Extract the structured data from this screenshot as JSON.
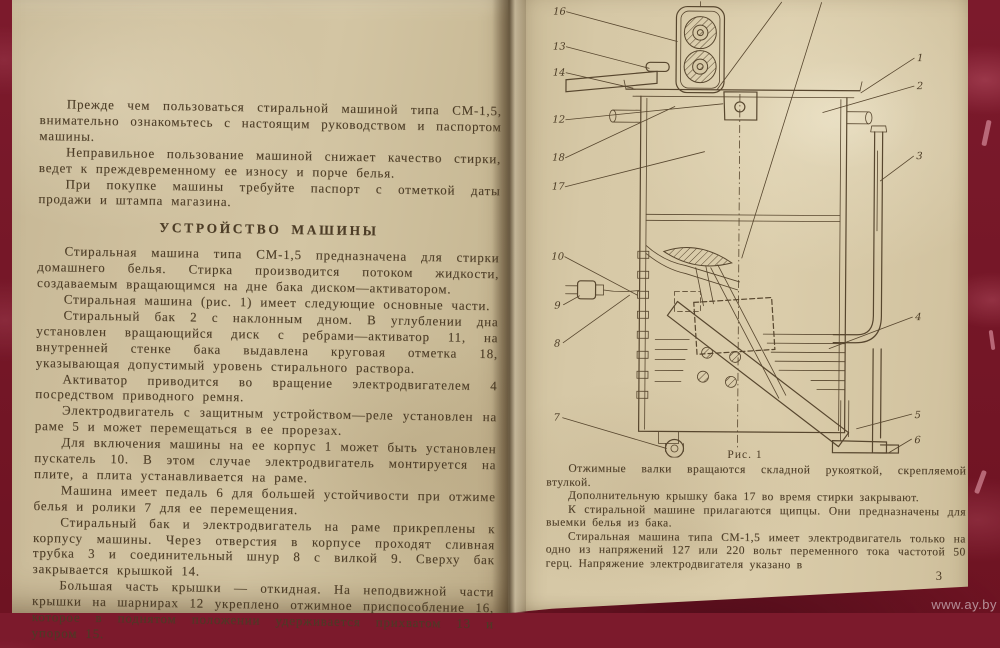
{
  "book": {
    "left_page": {
      "intro_paragraphs": [
        "Прежде чем пользоваться стиральной машиной типа СМ-1,5, внимательно ознакомьтесь с настоящим руководством и паспортом машины.",
        "Неправильное пользование машиной снижает качество стирки, ведет к преждевременному ее износу и порче белья.",
        "При покупке машины требуйте паспорт с отметкой даты продажи и штампа магазина."
      ],
      "section_heading": "УСТРОЙСТВО МАШИНЫ",
      "body_paragraphs": [
        "Стиральная машина типа СМ-1,5 предназначена для стирки домашнего белья. Стирка производится потоком жидкости, создаваемым вращающимся на дне бака диском—активатором.",
        "Стиральная машина (рис. 1) имеет следующие основные части.",
        "Стиральный бак 2 с наклонным дном. В углублении дна установлен вращающийся диск с ребрами—активатор 11, на внутренней стенке бака выдавлена круговая отметка 18, указывающая допустимый уровень стирального раствора.",
        "Активатор приводится во вращение электродвигателем 4 посредством приводного ремня.",
        "Электродвигатель с защитным устройством—реле установлен на раме 5 и может перемещаться в ее прорезах.",
        "Для включения машины на ее корпус 1 может быть установлен пускатель 10. В этом случае электродвигатель монтируется на плите, а плита устанавливается на раме.",
        "Машина имеет педаль 6 для большей устойчивости при отжиме белья и ролики 7 для ее перемещения.",
        "Стиральный бак и электродвигатель на раме прикреплены к корпусу машины. Через отверстия в корпусе проходят сливная трубка 3 и соединительный шнур 8 с вилкой 9. Сверху бак закрывается крышкой 14.",
        "Большая часть крышки — откидная. На неподвижной части крышки на шарнирах 12 укреплено отжимное приспособление 16, которое в поднятом положении удерживается прихватом 13 и упором 15."
      ]
    },
    "right_page": {
      "figure": {
        "caption": "Рис. 1",
        "callouts_left": [
          "16",
          "13",
          "14",
          "12",
          "18",
          "17",
          "10",
          "9",
          "8",
          "7"
        ],
        "callouts_right": [
          "1",
          "2",
          "3",
          "4",
          "5",
          "6"
        ]
      },
      "paragraphs": [
        "Отжимные валки вращаются складной рукояткой, скрепляемой втулкой.",
        "Дополнительную крышку бака 17 во время стирки закрывают.",
        "К стиральной машине прилагаются щипцы. Они предназначены для выемки белья из бака.",
        "Стиральная машина типа СМ-1,5 имеет электродвигатель только на одно из напряжений 127 или 220 вольт переменного тока частотой 50 герц. Напряжение электродвигателя указано в"
      ],
      "page_number": "3"
    }
  },
  "watermark": "www.ay.by",
  "colors": {
    "paper": "#d2c4a2",
    "fabric": "#7c1a2c",
    "ink": "#4c3c26"
  }
}
